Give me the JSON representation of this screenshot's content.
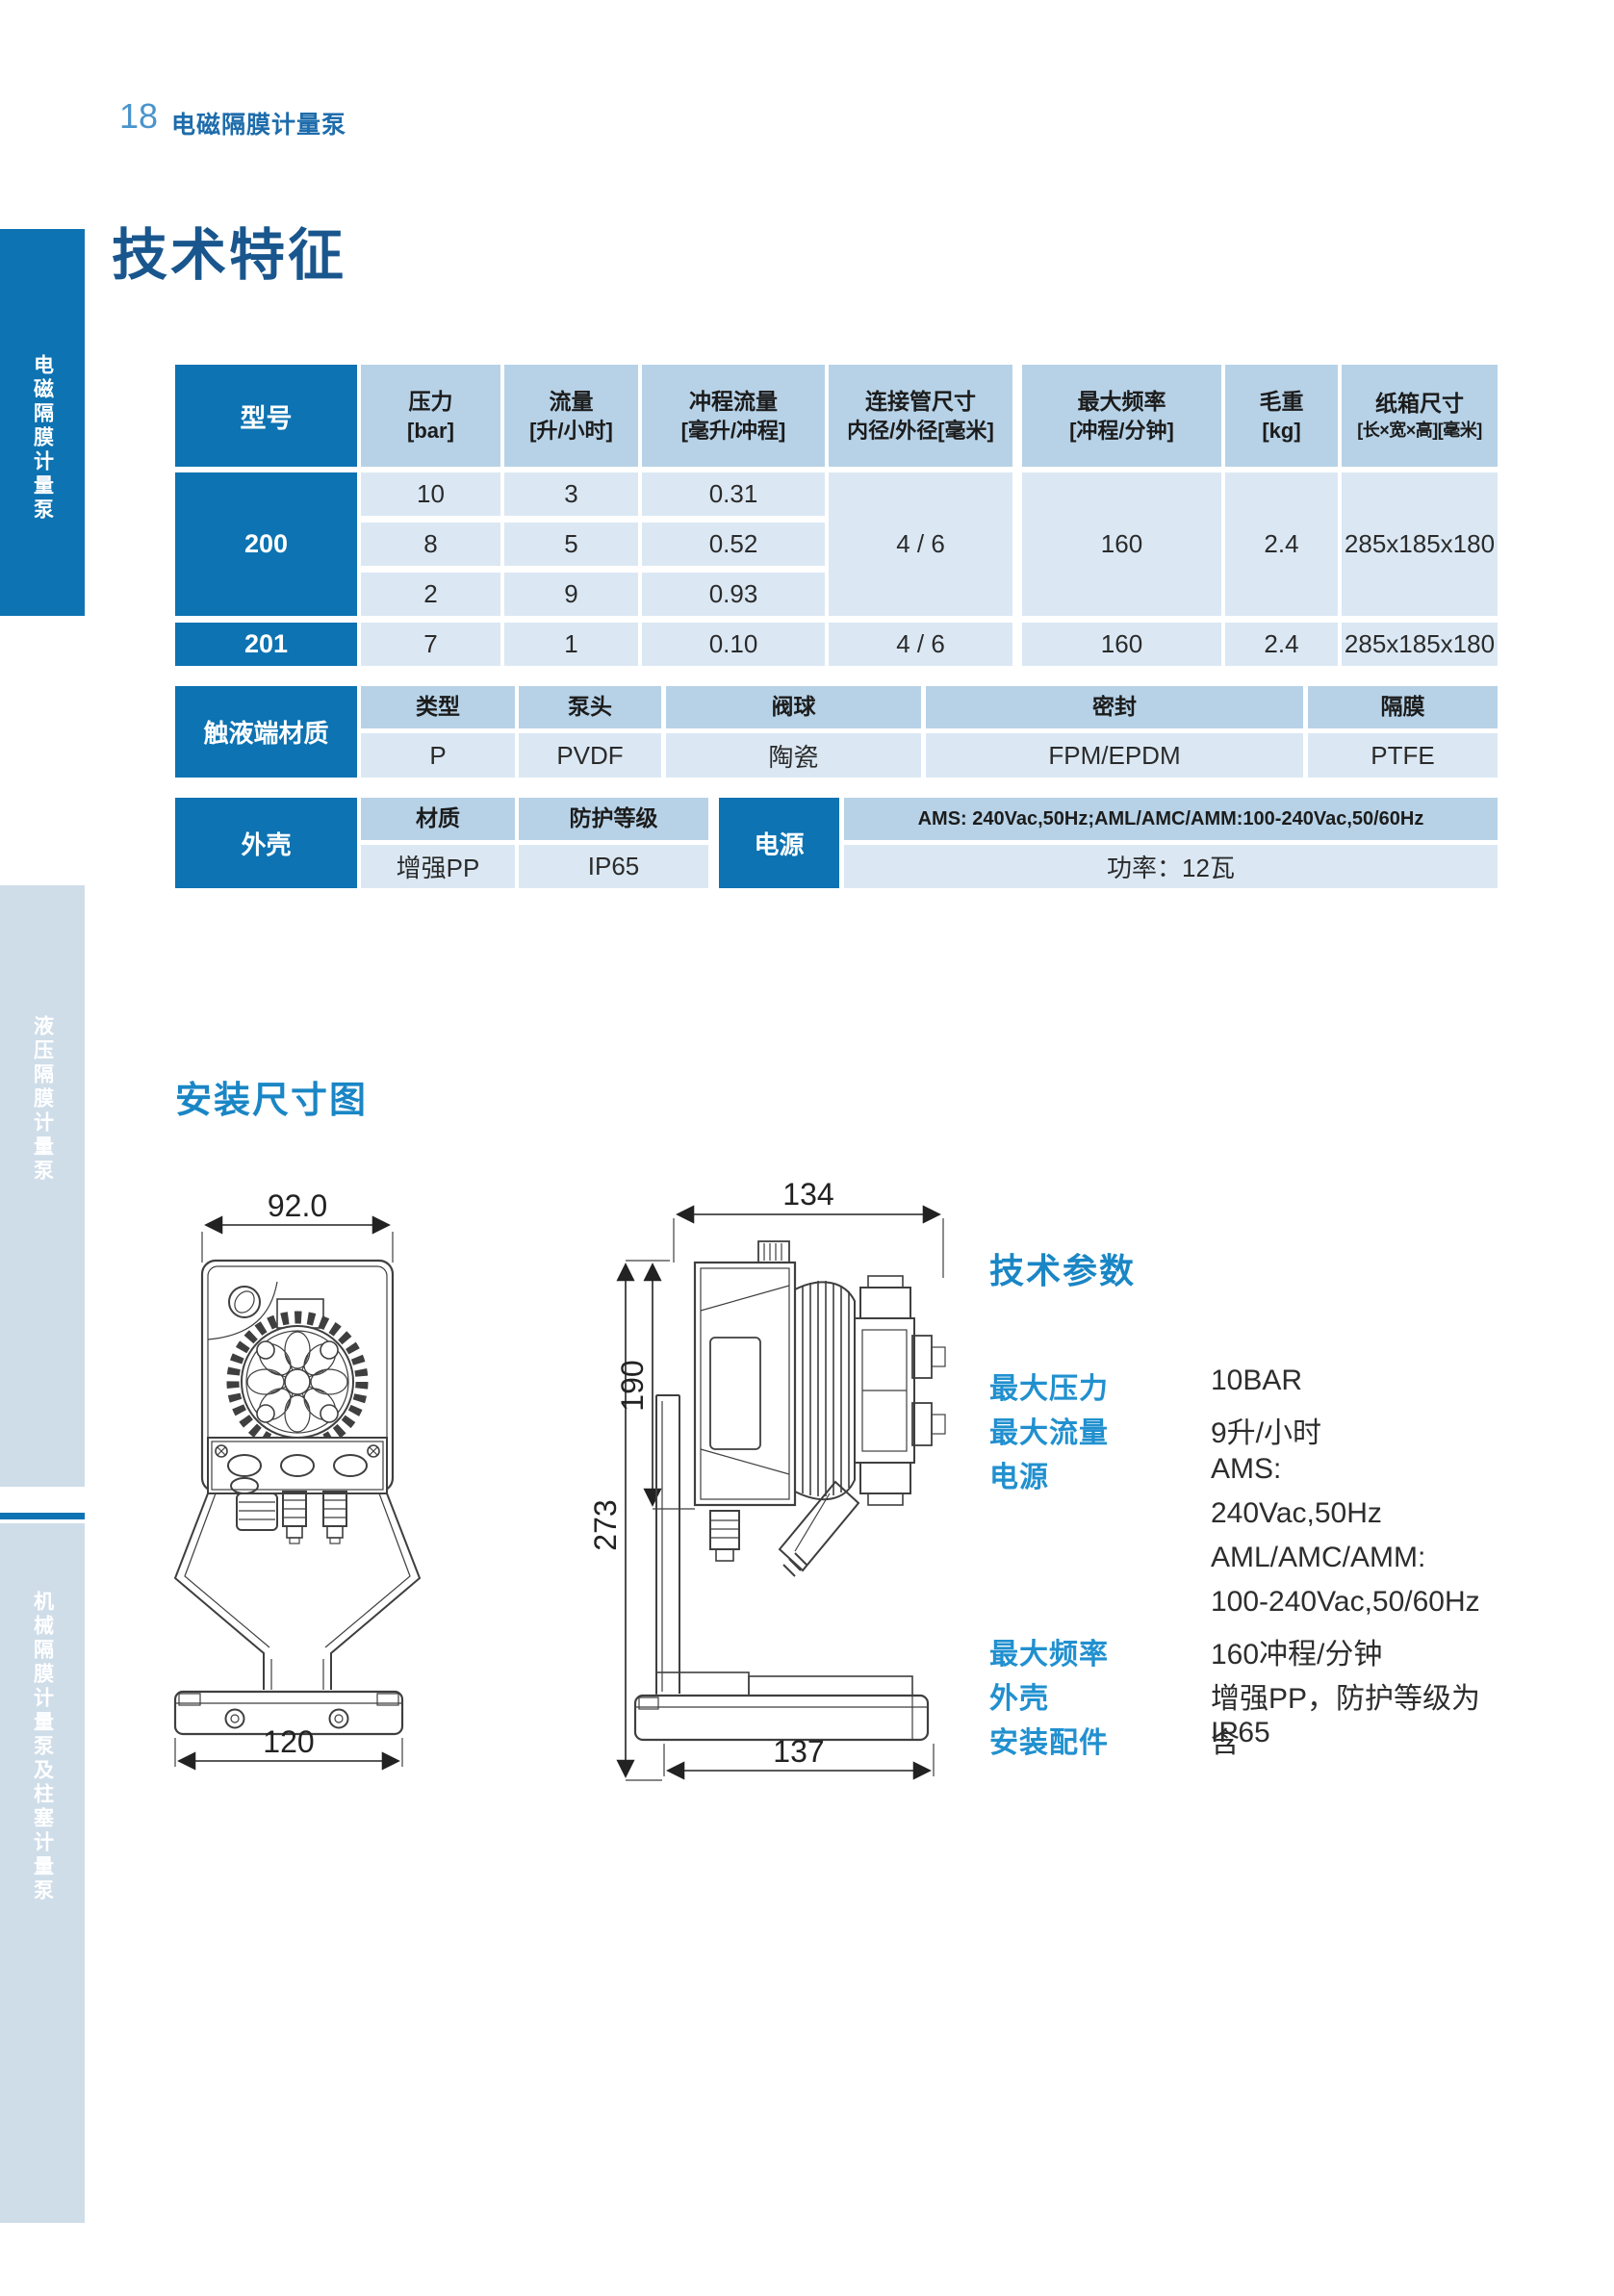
{
  "page": {
    "number": "18",
    "category": "电磁隔膜计量泵",
    "title": "技术特征"
  },
  "sidebar": {
    "tab1": "电磁隔膜计量泵",
    "tab2": "液压隔膜计量泵",
    "tab3": "机械隔膜计量泵及柱塞计量泵"
  },
  "colors": {
    "primary": "#0d73b2",
    "accent": "#1a86c5",
    "table_header_bg": "#b7d2e7",
    "table_row_bg": "#dbe8f4",
    "sidebar_inactive_bg": "#cfdde9"
  },
  "spec_table": {
    "col_model": "型号",
    "col_pressure_1": "压力",
    "col_pressure_2": "[bar]",
    "col_flow_1": "流量",
    "col_flow_2": "[升/小时]",
    "col_stroke_1": "冲程流量",
    "col_stroke_2": "[毫升/冲程]",
    "col_pipe_1": "连接管尺寸",
    "col_pipe_2": "内径/外径[毫米]",
    "col_freq_1": "最大频率",
    "col_freq_2": "[冲程/分钟]",
    "col_weight_1": "毛重",
    "col_weight_2": "[kg]",
    "col_carton_1": "纸箱尺寸",
    "col_carton_2": "[长×宽×高][毫米]",
    "m200": {
      "model": "200",
      "r1": [
        "10",
        "3",
        "0.31"
      ],
      "r2": [
        "8",
        "5",
        "0.52"
      ],
      "r3": [
        "2",
        "9",
        "0.93"
      ],
      "pipe": "4 / 6",
      "freq": "160",
      "weight": "2.4",
      "carton": "285x185x180"
    },
    "m201": {
      "model": "201",
      "pressure": "7",
      "flow": "1",
      "stroke": "0.10",
      "pipe": "4 / 6",
      "freq": "160",
      "weight": "2.4",
      "carton": "285x185x180"
    }
  },
  "materials_table": {
    "label": "触液端材质",
    "h": [
      "类型",
      "泵头",
      "阀球",
      "密封",
      "隔膜"
    ],
    "v": [
      "P",
      "PVDF",
      "陶瓷",
      "FPM/EPDM",
      "PTFE"
    ]
  },
  "housing_table": {
    "label": "外壳",
    "h1": "材质",
    "h2": "防护等级",
    "v1": "增强PP",
    "v2": "IP65"
  },
  "power_table": {
    "label": "电源",
    "spec": "AMS: 240Vac,50Hz;AML/AMC/AMM:100-240Vac,50/60Hz",
    "power": "功率：12瓦"
  },
  "installation": {
    "title": "安装尺寸图",
    "front_width": "92.0",
    "front_base": "120",
    "side_width": "134",
    "side_total": "273",
    "side_body": "190",
    "side_base": "137"
  },
  "tech_params": {
    "title": "技术参数",
    "rows": [
      {
        "label": "最大压力",
        "value": "10BAR"
      },
      {
        "label": "最大流量",
        "value": "9升/小时"
      },
      {
        "label": "电源",
        "value": "AMS:"
      },
      {
        "label": "",
        "value": "240Vac,50Hz"
      },
      {
        "label": "",
        "value": "AML/AMC/AMM:"
      },
      {
        "label": "",
        "value": "100-240Vac,50/60Hz"
      },
      {
        "label": "最大频率",
        "value": "160冲程/分钟"
      },
      {
        "label": "外壳",
        "value": "增强PP，防护等级为IP65"
      },
      {
        "label": "安装配件",
        "value": "含"
      }
    ]
  }
}
